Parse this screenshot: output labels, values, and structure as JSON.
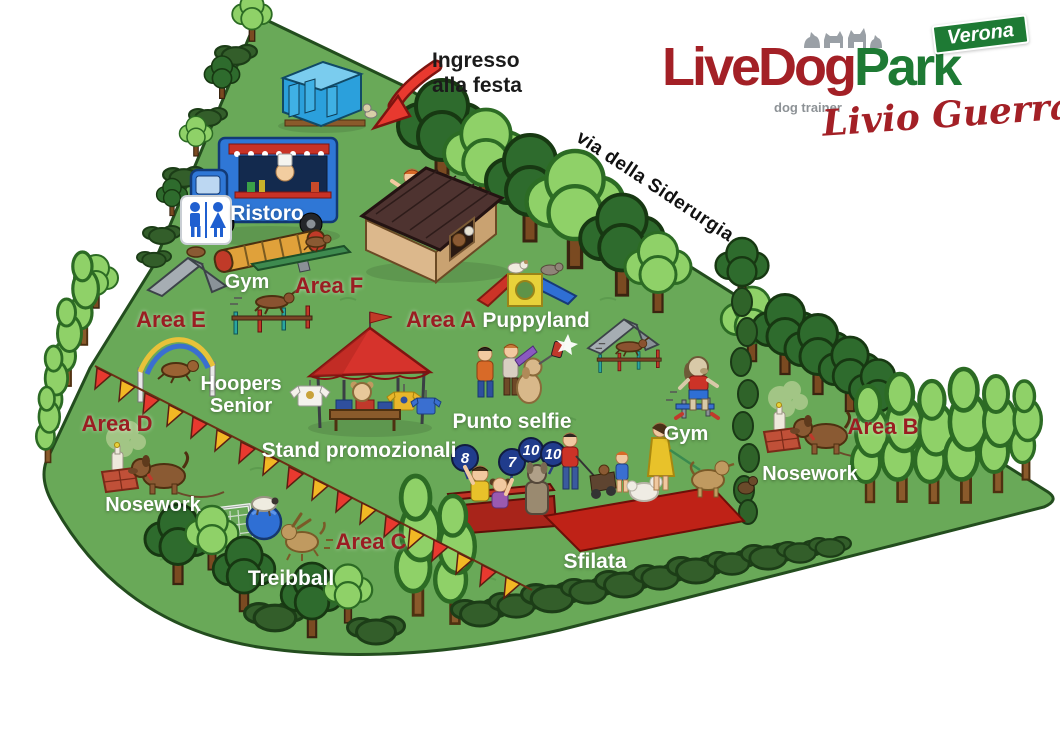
{
  "logo": {
    "name_red": "LiveDog",
    "name_green": "Park",
    "badge": "Verona",
    "subtitle": "dog trainer",
    "signature": "Livio Guerra"
  },
  "entrance": {
    "line1": "Ingresso",
    "line2": "alla festa"
  },
  "street_name": "via della Siderurgia",
  "labels": {
    "ristoro": "Ristoro",
    "gym_west": "Gym",
    "area_f": "Area F",
    "area_e": "Area E",
    "area_a": "Area A",
    "puppyland": "Puppyland",
    "hoopers_line1": "Hoopers",
    "hoopers_line2": "Senior",
    "area_d": "Area D",
    "nosework_west": "Nosework",
    "stand_promozionali": "Stand promozionali",
    "punto_selfie": "Punto selfie",
    "gym_east": "Gym",
    "area_b": "Area B",
    "nosework_east": "Nosework",
    "area_c": "Area C",
    "treibball": "Treibball",
    "sfilata": "Sfilata"
  },
  "judge_scores": {
    "paddle1": "8",
    "paddle2": "7",
    "paddle3": "10",
    "paddle4": "10"
  },
  "colors": {
    "grass": "#69a958",
    "outline": "#234d1e",
    "tree_dark": "#2e6b2d",
    "tree_mid": "#4c8a3c",
    "tree_light": "#8fd168",
    "label_red": "#9a1d22",
    "logo_red": "#a32026",
    "logo_green": "#1e7a34",
    "logo_gray": "#8d9296",
    "bunting_red": "#e8392f",
    "bunting_yellow": "#f2b824",
    "tent_red": "#d6332c",
    "carpet_red": "#bf2217",
    "truck_blue": "#2f77d6",
    "toilet_blue": "#2ba0dc",
    "score_blue": "#203c8c",
    "arrow_red": "#e8392f",
    "ink": "#1b1b1b"
  }
}
